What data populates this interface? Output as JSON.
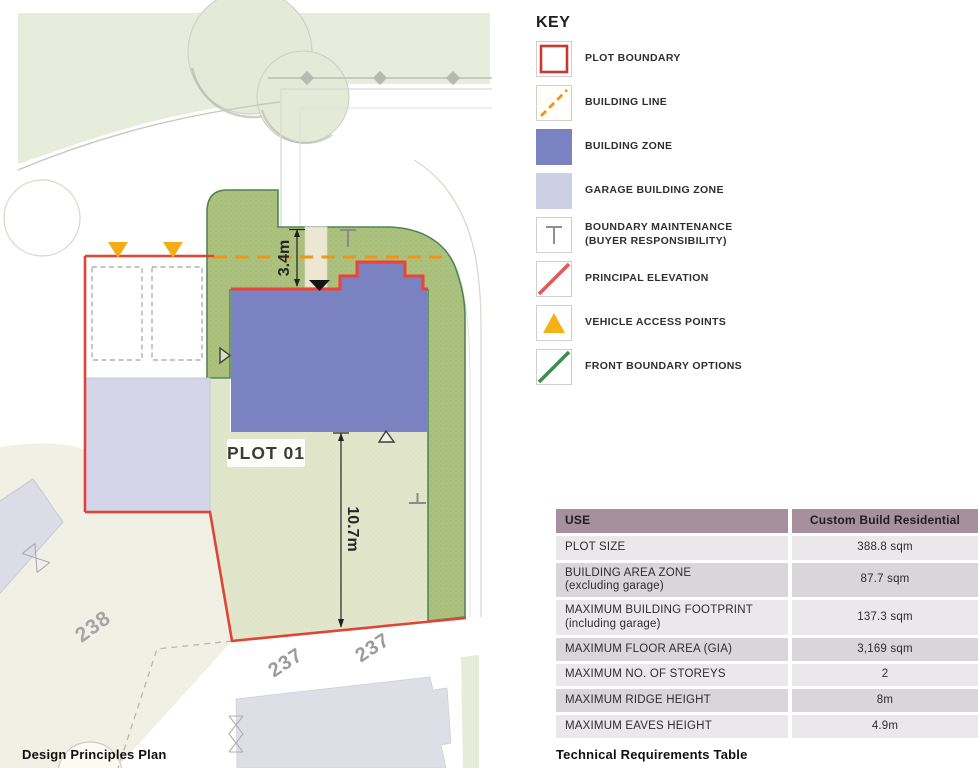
{
  "plan": {
    "caption": "Design Principles Plan",
    "plot_label": "PLOT 01",
    "front_setback_dimension": "3.4m",
    "garden_depth_dimension": "10.7m",
    "neighbor_plot_left": "238",
    "neighbor_plot_bottom_left": "237",
    "neighbor_plot_bottom_right": "237"
  },
  "key": {
    "title": "KEY",
    "items": [
      {
        "id": "plot-boundary",
        "label": "PLOT BOUNDARY"
      },
      {
        "id": "building-line",
        "label": "BUILDING LINE"
      },
      {
        "id": "building-zone",
        "label": "BUILDING ZONE"
      },
      {
        "id": "garage-building-zone",
        "label": "GARAGE BUILDING ZONE"
      },
      {
        "id": "boundary-maintenance",
        "label": "BOUNDARY MAINTENANCE\n(BUYER RESPONSIBILITY)"
      },
      {
        "id": "principal-elevation",
        "label": "PRINCIPAL ELEVATION"
      },
      {
        "id": "vehicle-access-points",
        "label": "VEHICLE ACCESS POINTS"
      },
      {
        "id": "front-boundary-options",
        "label": "FRONT BOUNDARY OPTIONS"
      }
    ]
  },
  "table": {
    "caption": "Technical Requirements Table",
    "header": {
      "use": "USE",
      "value": "Custom Build Residential"
    },
    "rows": [
      {
        "label": "PLOT SIZE",
        "value": "388.8 sqm"
      },
      {
        "label": "BUILDING AREA ZONE\n(excluding garage)",
        "value": "87.7 sqm"
      },
      {
        "label": "MAXIMUM BUILDING FOOTPRINT\n(including garage)",
        "value": "137.3 sqm"
      },
      {
        "label": "MAXIMUM FLOOR AREA (GIA)",
        "value": "3,169 sqm"
      },
      {
        "label": "MAXIMUM NO. OF STOREYS",
        "value": "2"
      },
      {
        "label": "MAXIMUM RIDGE HEIGHT",
        "value": "8m"
      },
      {
        "label": "MAXIMUM EAVES HEIGHT",
        "value": "4.9m"
      }
    ]
  },
  "colors": {
    "plot_boundary_red": "#d8423b",
    "building_line_orange": "#ef9415",
    "building_zone_purple": "#7a82c1",
    "garage_zone_lavender": "#cdcfe6",
    "principal_elevation_red": "#dd5c55",
    "vehicle_access_yellow": "#f6b215",
    "front_boundary_green": "#3f8d53",
    "landscape_band_green": "#abc17d",
    "garden_green": "#e1e6ca",
    "table_header_mauve": "#a6909d",
    "table_row_light": "#eae8ea",
    "table_row_dark": "#d9d6d9"
  }
}
